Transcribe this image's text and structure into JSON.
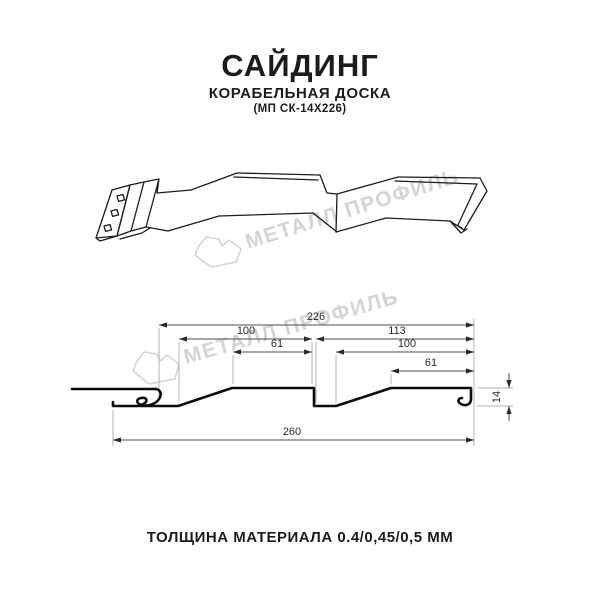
{
  "header": {
    "title": "САЙДИНГ",
    "subtitle": "КОРАБЕЛЬНАЯ ДОСКА",
    "model": "(МП СК-14Х226)"
  },
  "watermark": {
    "brand": "МЕТАЛЛ ПРОФИЛЬ"
  },
  "dims": {
    "cover_width": "226",
    "left_section": "100",
    "right_section": "113",
    "left_board": "61",
    "right_sub": "100",
    "right_board": "61",
    "overall_width": "260",
    "height": "14"
  },
  "footer": {
    "thickness_label": "ТОЛЩИНА МАТЕРИАЛА 0.4/0,45/0,5 ММ"
  },
  "colors": {
    "ink": "#1c1c1c",
    "watermark": "#d4d4d4"
  }
}
